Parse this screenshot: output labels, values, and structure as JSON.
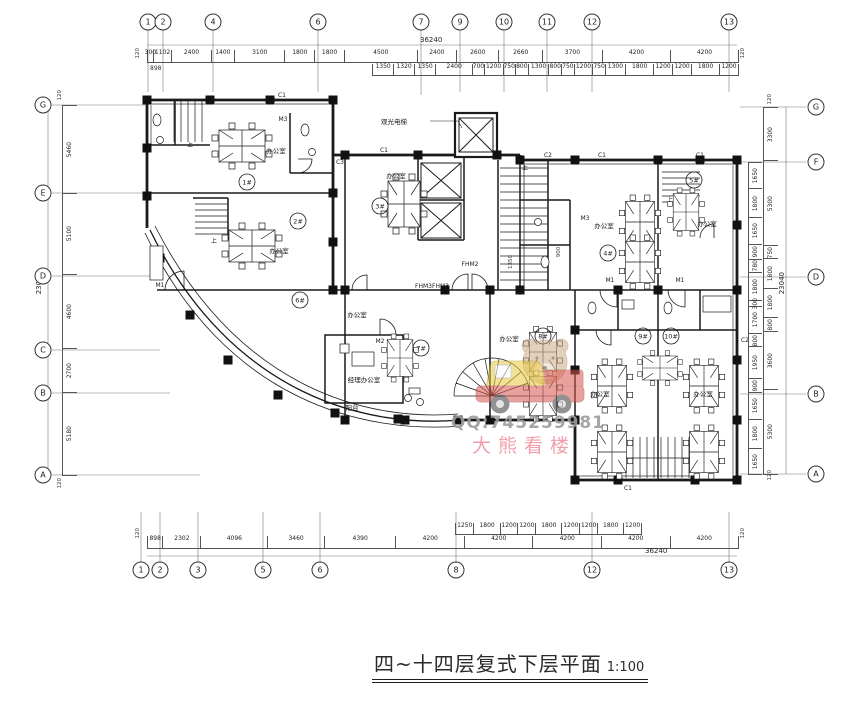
{
  "title": {
    "text": "四~十四层复式下层平面",
    "scale": "1:100"
  },
  "watermark": {
    "qq": "QQ:745259981",
    "name": "大熊看楼"
  },
  "axes": {
    "top": [
      "1",
      "2",
      "4",
      "6",
      "7",
      "9",
      "10",
      "11",
      "12",
      "13"
    ],
    "bottom": [
      "1",
      "2",
      "3",
      "5",
      "6",
      "8",
      "12",
      "13"
    ],
    "left": [
      "G",
      "E",
      "D",
      "C",
      "B",
      "A"
    ],
    "right": [
      "G",
      "F",
      "D",
      "B",
      "A"
    ]
  },
  "dimensions": {
    "top_total": "36240",
    "bottom_total": "36240",
    "left_total": "23040",
    "right_total": "23040",
    "edge": "120",
    "left_offset": "898",
    "top_row1": [
      "300",
      "1102",
      "2400",
      "1400",
      "3100",
      "1800",
      "1800",
      "4500",
      "2400",
      "2600",
      "2660",
      "3700",
      "4200",
      "4200"
    ],
    "top_row2": [
      "1350",
      "1320",
      "1350",
      "2400",
      "700",
      "1200",
      "750",
      "800",
      "1300",
      "800",
      "750",
      "1200",
      "750",
      "1300",
      "1800",
      "1200",
      "1200",
      "1800",
      "1200"
    ],
    "bottom_sub": [
      "1250",
      "1800",
      "1200",
      "1200",
      "1800",
      "1200",
      "1200",
      "1800",
      "1200"
    ],
    "bottom_main": [
      "898",
      "2302",
      "4096",
      "3460",
      "4390",
      "4200",
      "4200",
      "4200",
      "4200",
      "4200"
    ],
    "left_col": [
      "5460",
      "5100",
      "4600",
      "2700",
      "5180"
    ],
    "right_inner": [
      "1650",
      "1800",
      "1650",
      "900",
      "780",
      "1800",
      "300",
      "1700",
      "800",
      "1950",
      "900",
      "1650",
      "1800",
      "1650"
    ],
    "right_outer": [
      "3300",
      "5300",
      "750",
      "1800",
      "1800",
      "800",
      "3600",
      "5300"
    ],
    "interior": [
      "1350",
      "900"
    ]
  },
  "rooms": {
    "office": "办公室",
    "manager_office": "经理办公室",
    "balcony": "阳台",
    "observation_elevator": "观光电梯",
    "units": [
      "1#",
      "2#",
      "3#",
      "4#",
      "5#",
      "6#",
      "7#",
      "8#",
      "9#",
      "10#"
    ]
  },
  "tags": {
    "c1": "C1",
    "c2": "C2",
    "c3": "C3",
    "m1": "M1",
    "m2": "M2",
    "m3": "M3",
    "fhm2": "FHM2",
    "fhm3": "FHM3FHM3",
    "up": "上"
  }
}
